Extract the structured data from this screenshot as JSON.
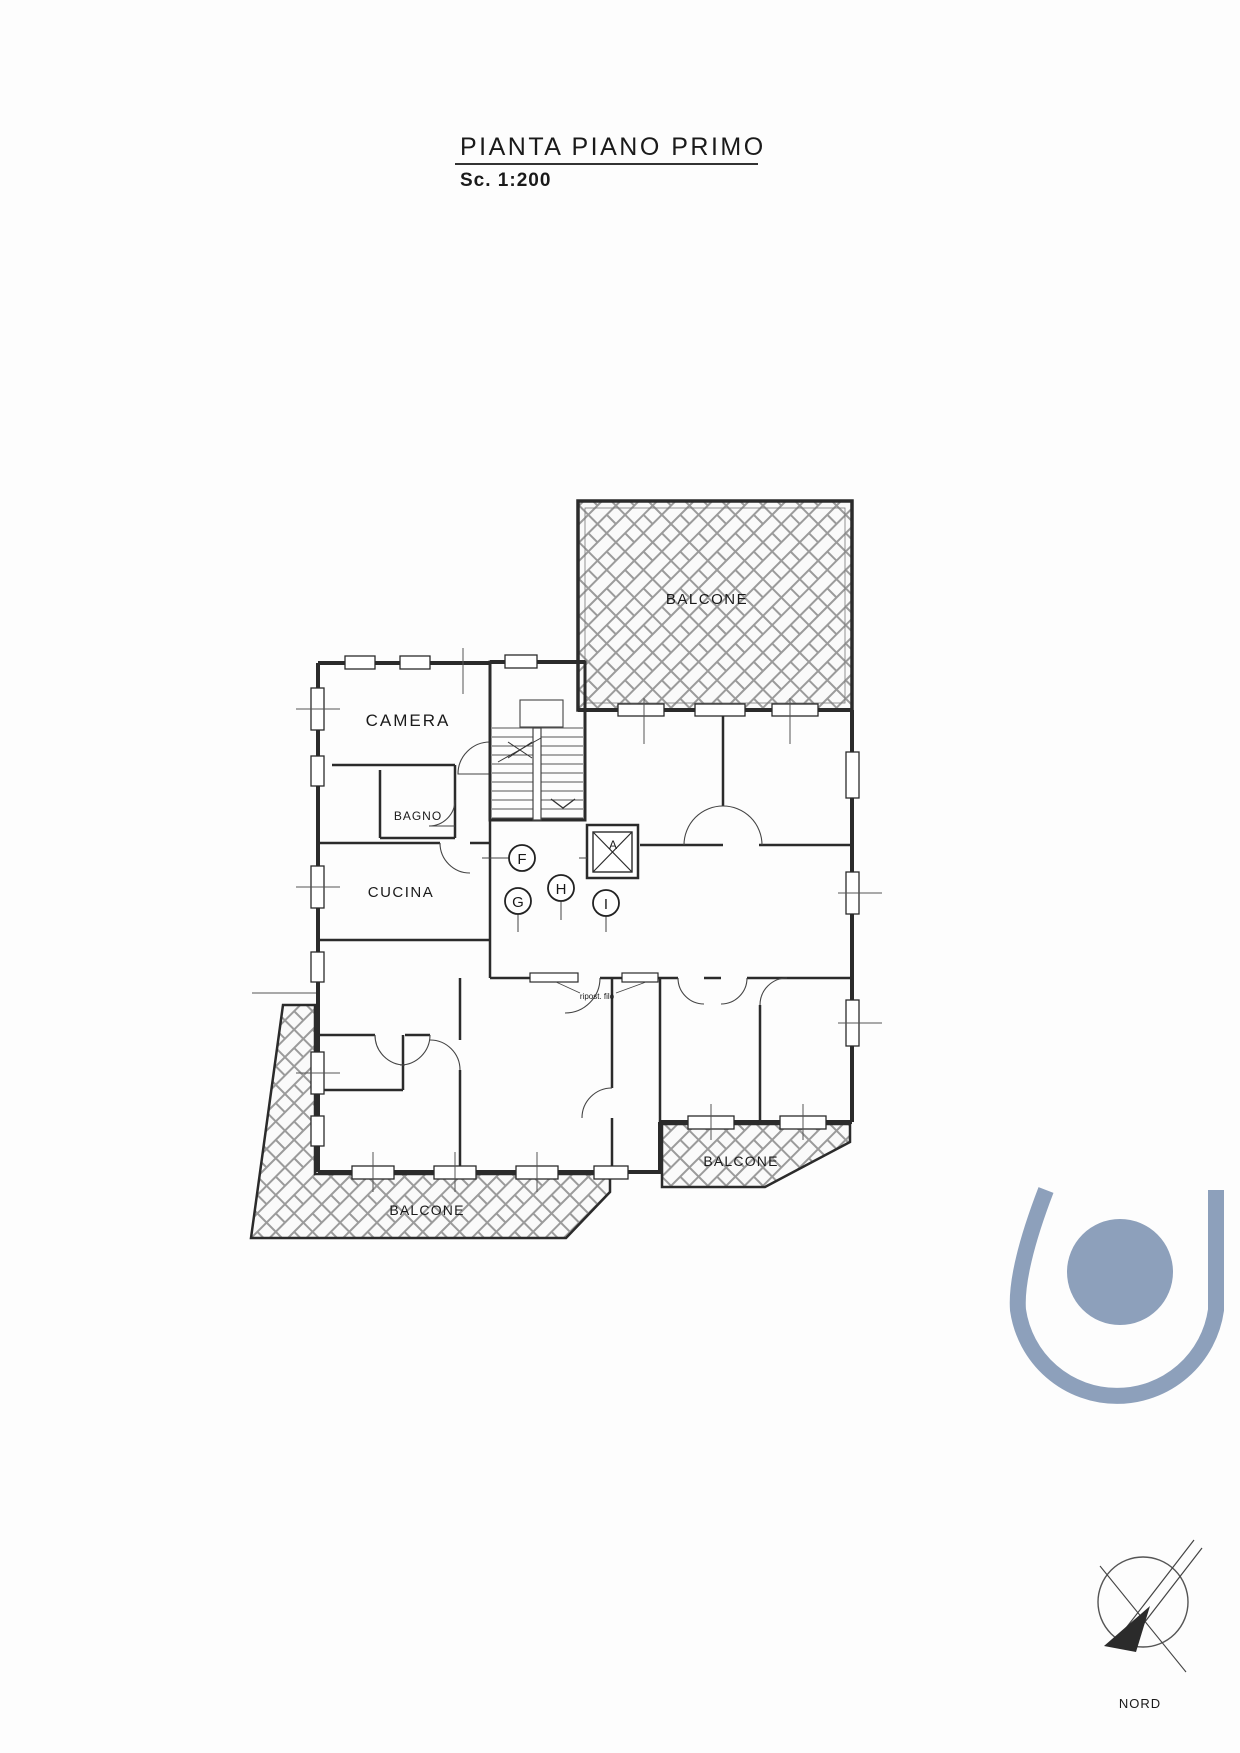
{
  "title": {
    "text": "PIANTA PIANO PRIMO",
    "scale": "Sc. 1:200"
  },
  "plan": {
    "balconies": {
      "top": "BALCONE",
      "bottom_left": "BALCONE",
      "bottom_right": "BALCONE"
    },
    "rooms": {
      "camera": "CAMERA",
      "bagno": "BAGNO",
      "cucina": "CUCINA"
    },
    "unit_markers": {
      "f": "F",
      "g": "G",
      "h": "H",
      "i": "I"
    },
    "elevator_label": "A",
    "closet_note": "ripost. filo"
  },
  "compass": {
    "label": "NORD"
  },
  "colors": {
    "logo": "#8DA0BB",
    "line": "#2b2b2b"
  }
}
